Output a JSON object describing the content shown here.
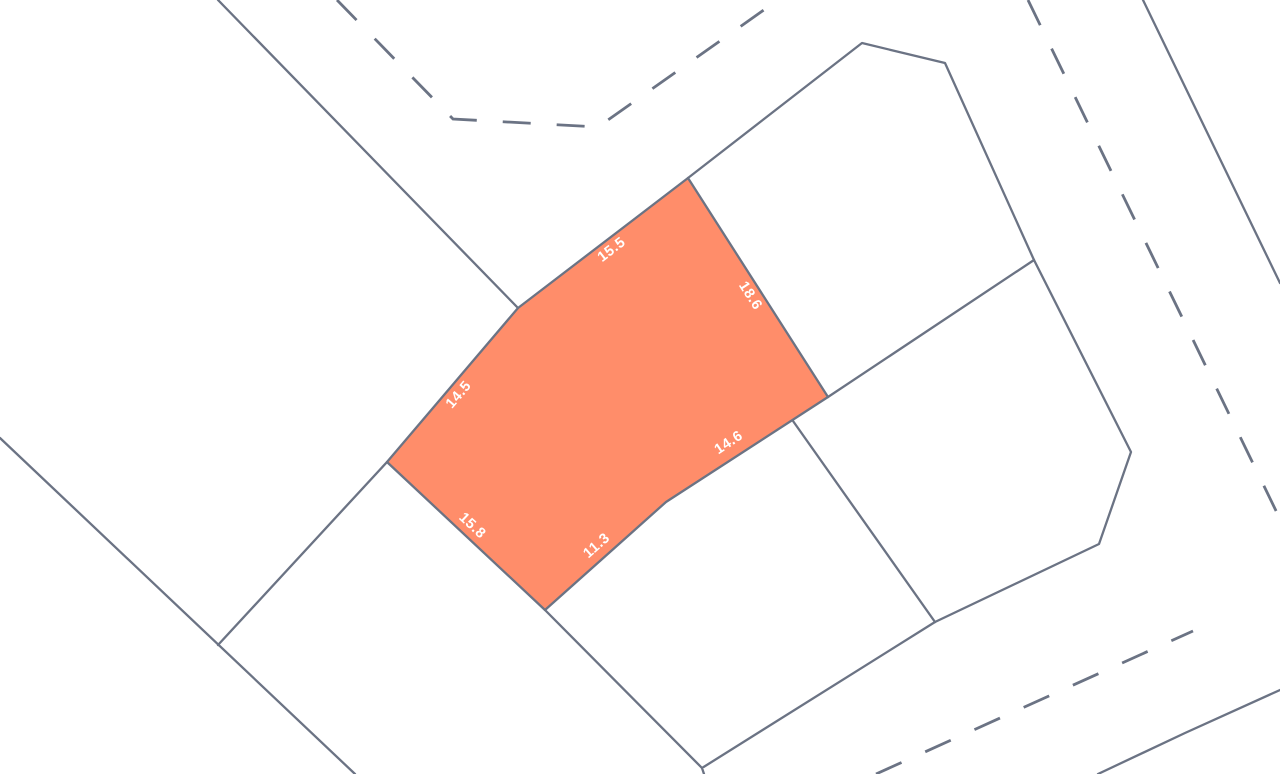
{
  "map": {
    "colors": {
      "background": "#ffffff",
      "line": "#6b7384",
      "parcel_fill": "#ff8d6a",
      "label_text": "#ffffff"
    },
    "highlighted_parcel": {
      "vertices": [
        [
          688,
          178
        ],
        [
          828,
          397
        ],
        [
          666,
          502
        ],
        [
          545,
          610
        ],
        [
          387,
          462
        ],
        [
          518,
          308
        ]
      ],
      "edge_labels": [
        {
          "text": "15.5",
          "x": 612,
          "y": 250,
          "angle": -37.5
        },
        {
          "text": "18.6",
          "x": 750,
          "y": 296,
          "angle": 57.5
        },
        {
          "text": "14.6",
          "x": 729,
          "y": 443,
          "angle": -33.5
        },
        {
          "text": "11.3",
          "x": 597,
          "y": 546,
          "angle": -41.5
        },
        {
          "text": "15.8",
          "x": 472,
          "y": 526,
          "angle": 43
        },
        {
          "text": "14.5",
          "x": 459,
          "y": 395,
          "angle": -49.5
        }
      ]
    },
    "boundary_lines": [
      {
        "points": [
          [
            218,
            0
          ],
          [
            518,
            308
          ]
        ]
      },
      {
        "points": [
          [
            688,
            178
          ],
          [
            862,
            43
          ],
          [
            945,
            63
          ],
          [
            1034,
            260
          ],
          [
            1131,
            452
          ],
          [
            1099,
            544
          ],
          [
            935,
            622
          ],
          [
            702,
            768
          ],
          [
            704,
            774
          ]
        ]
      },
      {
        "points": [
          [
            1034,
            260
          ],
          [
            828,
            397
          ]
        ]
      },
      {
        "points": [
          [
            793,
            421
          ],
          [
            935,
            622
          ]
        ]
      },
      {
        "points": [
          [
            545,
            610
          ],
          [
            702,
            768
          ]
        ]
      },
      {
        "points": [
          [
            0,
            438
          ],
          [
            355,
            774
          ]
        ]
      },
      {
        "points": [
          [
            218,
            645
          ],
          [
            387,
            462
          ]
        ]
      },
      {
        "points": [
          [
            1143,
            0
          ],
          [
            1280,
            283
          ]
        ]
      },
      {
        "points": [
          [
            1098,
            774
          ],
          [
            1185,
            733
          ],
          [
            1280,
            690
          ]
        ]
      }
    ],
    "dashed_roads": [
      {
        "points": [
          [
            337,
            0
          ],
          [
            453,
            119
          ],
          [
            598,
            127
          ],
          [
            778,
            0
          ]
        ]
      },
      {
        "points": [
          [
            1028,
            0
          ],
          [
            1280,
            519
          ]
        ]
      },
      {
        "points": [
          [
            876,
            774
          ],
          [
            1193,
            631
          ]
        ]
      }
    ]
  }
}
